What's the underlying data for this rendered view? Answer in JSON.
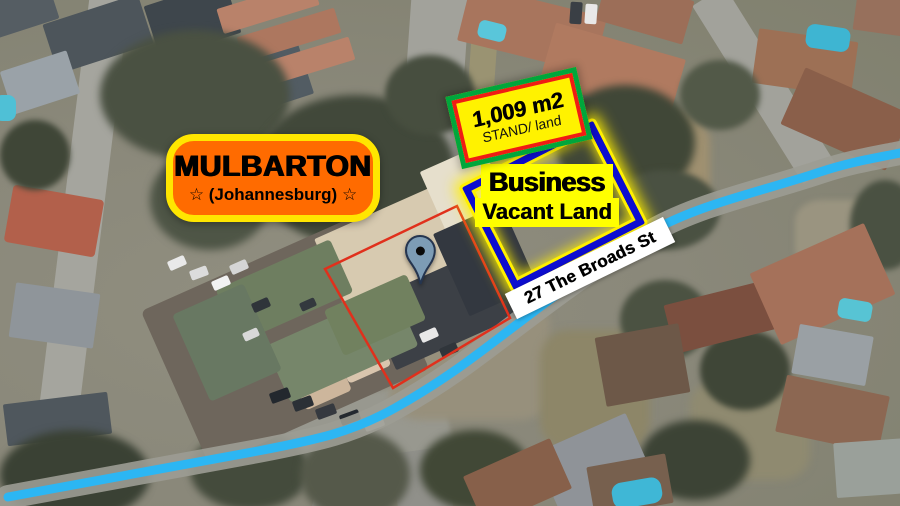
{
  "colors": {
    "brand-orange": "#ff6b00",
    "brand-yellow": "#ffe600",
    "stand-yellow": "#fff200",
    "stand-green": "#00a63c",
    "stand-red": "#f01c14",
    "plot-blue": "#0d0dd0",
    "plot-glow": "#ffef00",
    "label-yellow": "#ffff00",
    "road-highlight": "#2cb6f3",
    "road-gray": "#9c9c94",
    "red-outline": "#e0301c",
    "banner-white": "#ffffff",
    "text-black": "#000000",
    "pin-fill": "#7d9cb5",
    "pin-stroke": "#25354f"
  },
  "area_label": {
    "title": "MULBARTON",
    "subtitle": "☆  (Johannesburg)  ☆"
  },
  "stand_label": {
    "size": "1,009 m2",
    "type": "STAND/ land"
  },
  "plot_label": {
    "line1": "Business",
    "line2": "Vacant Land"
  },
  "street_label": {
    "name": "27 The Broads St"
  },
  "shapes": {
    "highlight_road_path": "M8 497 L258 451 C320 439 352 432 395 408 C450 377 480 352 520 322 C565 288 610 255 652 231 C700 204 760 192 820 172 C850 162 875 158 900 153",
    "red_plot_points": "325,269 457,206 510,318 393,388"
  },
  "map_features": [
    {
      "n": "aerial-road",
      "x": 58,
      "y": -15,
      "w": 40,
      "h": 540,
      "c": "#a5a59e",
      "r": 7
    },
    {
      "n": "aerial-road",
      "x": 405,
      "y": -10,
      "w": 58,
      "h": 200,
      "c": "#a2a29b",
      "r": 4
    },
    {
      "n": "aerial-verge",
      "x": 468,
      "y": 0,
      "w": 26,
      "h": 175,
      "c": "#9a9372",
      "r": 4
    },
    {
      "n": "aerial-road",
      "x": 745,
      "y": -20,
      "w": 38,
      "h": 210,
      "c": "#a2a29b",
      "r": -32
    },
    {
      "n": "aerial-road",
      "x": 230,
      "y": 400,
      "w": 220,
      "h": 80,
      "c": "#98988f",
      "r": -12,
      "br": "10px",
      "bl": 2
    },
    {
      "n": "aerial-road",
      "x": 320,
      "y": 440,
      "w": 60,
      "h": 80,
      "c": "#93938a",
      "r": 15
    },
    {
      "n": "aerial-road",
      "x": 395,
      "y": 450,
      "w": 55,
      "h": 70,
      "c": "#90908a",
      "r": -8
    },
    {
      "n": "aerial-ground",
      "x": 580,
      "y": 110,
      "w": 130,
      "h": 110,
      "c": "#9f9070",
      "br": "30%",
      "bl": 4
    },
    {
      "n": "aerial-ground",
      "x": 390,
      "y": 300,
      "w": 160,
      "h": 120,
      "c": "#97907c",
      "br": "20%",
      "bl": 4
    },
    {
      "n": "aerial-ground",
      "x": 690,
      "y": 380,
      "w": 120,
      "h": 100,
      "c": "#8f8a70",
      "br": "25%",
      "bl": 4
    },
    {
      "n": "aerial-ground",
      "x": 540,
      "y": 330,
      "w": 110,
      "h": 120,
      "c": "#8d8668",
      "br": "25%",
      "bl": 4
    },
    {
      "n": "aerial-ground",
      "x": 795,
      "y": 200,
      "w": 90,
      "h": 70,
      "c": "#9a9480",
      "br": "30%",
      "bl": 3
    },
    {
      "n": "aerial-house",
      "x": -15,
      "y": -10,
      "w": 70,
      "h": 40,
      "c": "#555d63",
      "r": -18
    },
    {
      "n": "aerial-house",
      "x": 48,
      "y": 8,
      "w": 100,
      "h": 52,
      "c": "#4d555b",
      "r": -18
    },
    {
      "n": "aerial-house",
      "x": 150,
      "y": -8,
      "w": 85,
      "h": 55,
      "c": "#3e464c",
      "r": -18
    },
    {
      "n": "aerial-house",
      "x": 228,
      "y": 55,
      "w": 80,
      "h": 52,
      "c": "#525c63",
      "r": -18
    },
    {
      "n": "aerial-house",
      "x": 5,
      "y": 60,
      "w": 70,
      "h": 45,
      "c": "#9aa2a8",
      "r": -18
    },
    {
      "n": "aerial-house",
      "x": 218,
      "y": -6,
      "w": 100,
      "h": 26,
      "c": "#b9826a",
      "r": -17
    },
    {
      "n": "aerial-house",
      "x": 238,
      "y": 22,
      "w": 102,
      "h": 26,
      "c": "#ad775f",
      "r": -17
    },
    {
      "n": "aerial-house",
      "x": 258,
      "y": 50,
      "w": 96,
      "h": 24,
      "c": "#b9826a",
      "r": -17
    },
    {
      "n": "aerial-pool",
      "x": -6,
      "y": 95,
      "w": 22,
      "h": 26,
      "c": "#4fc0d6",
      "br": "8px"
    },
    {
      "n": "aerial-house",
      "x": 8,
      "y": 192,
      "w": 92,
      "h": 58,
      "c": "#b2604b",
      "r": 10,
      "br": "4px"
    },
    {
      "n": "aerial-house",
      "x": 12,
      "y": 288,
      "w": 85,
      "h": 55,
      "c": "#8f959a",
      "r": 8
    },
    {
      "n": "aerial-house",
      "x": 5,
      "y": 398,
      "w": 105,
      "h": 42,
      "c": "#4f575d",
      "r": -7
    },
    {
      "n": "aerial-house",
      "x": 462,
      "y": 0,
      "w": 140,
      "h": 58,
      "c": "#a8755d",
      "r": 14
    },
    {
      "n": "aerial-house",
      "x": 545,
      "y": 40,
      "w": 135,
      "h": 62,
      "c": "#b07a60",
      "r": 16
    },
    {
      "n": "aerial-house",
      "x": 600,
      "y": -12,
      "w": 90,
      "h": 45,
      "c": "#9c6e58",
      "r": 16
    },
    {
      "n": "aerial-house",
      "x": 755,
      "y": 35,
      "w": 100,
      "h": 55,
      "c": "#9d7055",
      "r": 8
    },
    {
      "n": "aerial-house",
      "x": 788,
      "y": 88,
      "w": 115,
      "h": 62,
      "c": "#8a5f4a",
      "r": 24
    },
    {
      "n": "aerial-house",
      "x": 855,
      "y": -5,
      "w": 50,
      "h": 38,
      "c": "#97705c",
      "r": 8
    },
    {
      "n": "aerial-pool",
      "x": 478,
      "y": 22,
      "w": 28,
      "h": 18,
      "c": "#59c6da",
      "r": 14,
      "br": "6px"
    },
    {
      "n": "aerial-pool",
      "x": 806,
      "y": 26,
      "w": 44,
      "h": 24,
      "c": "#3eb5d2",
      "r": 8,
      "br": "8px"
    },
    {
      "n": "aerial-car",
      "x": 570,
      "y": 2,
      "w": 12,
      "h": 22,
      "c": "#3a3f45",
      "r": 4
    },
    {
      "n": "aerial-car",
      "x": 585,
      "y": 4,
      "w": 12,
      "h": 20,
      "c": "#e8e8e8",
      "r": 4
    },
    {
      "n": "aerial-trees",
      "x": 100,
      "y": 30,
      "w": 190,
      "h": 130,
      "c": "#4a5142",
      "br": "50%",
      "bl": 4
    },
    {
      "n": "aerial-trees",
      "x": 255,
      "y": 95,
      "w": 200,
      "h": 150,
      "c": "#41483a",
      "br": "50%",
      "bl": 4
    },
    {
      "n": "aerial-trees",
      "x": 150,
      "y": 150,
      "w": 120,
      "h": 100,
      "c": "#4e5546",
      "br": "50%",
      "bl": 4
    },
    {
      "n": "aerial-trees",
      "x": 385,
      "y": 55,
      "w": 90,
      "h": 80,
      "c": "#474e3f",
      "br": "50%",
      "bl": 3
    },
    {
      "n": "aerial-trees",
      "x": 555,
      "y": 85,
      "w": 140,
      "h": 115,
      "c": "#404737",
      "br": "50%",
      "bl": 4
    },
    {
      "n": "aerial-trees",
      "x": 610,
      "y": 170,
      "w": 110,
      "h": 80,
      "c": "#4a5142",
      "br": "50%",
      "bl": 3
    },
    {
      "n": "aerial-trees",
      "x": 680,
      "y": 60,
      "w": 80,
      "h": 70,
      "c": "#525948",
      "br": "50%",
      "bl": 3
    },
    {
      "n": "aerial-trees",
      "x": 0,
      "y": 120,
      "w": 70,
      "h": 70,
      "c": "#3f4637",
      "br": "50%",
      "bl": 3
    },
    {
      "n": "aerial-trees",
      "x": 0,
      "y": 430,
      "w": 150,
      "h": 90,
      "c": "#3a4134",
      "br": "50%",
      "bl": 4
    },
    {
      "n": "aerial-trees",
      "x": 190,
      "y": 430,
      "w": 120,
      "h": 80,
      "c": "#444b3c",
      "br": "50%",
      "bl": 4
    },
    {
      "n": "aerial-trees",
      "x": 290,
      "y": 240,
      "w": 70,
      "h": 60,
      "c": "#49503f",
      "br": "50%",
      "bl": 3
    },
    {
      "n": "aerial-trees",
      "x": 420,
      "y": 430,
      "w": 110,
      "h": 80,
      "c": "#414836",
      "br": "50%",
      "bl": 4
    },
    {
      "n": "aerial-trees",
      "x": 300,
      "y": 430,
      "w": 110,
      "h": 90,
      "c": "#55594a",
      "br": "50%",
      "bl": 4
    },
    {
      "n": "aerial-trees",
      "x": 620,
      "y": 280,
      "w": 90,
      "h": 80,
      "c": "#4b5242",
      "br": "50%",
      "bl": 3
    },
    {
      "n": "aerial-trees",
      "x": 700,
      "y": 330,
      "w": 90,
      "h": 80,
      "c": "#3f4637",
      "br": "50%",
      "bl": 3
    },
    {
      "n": "aerial-trees",
      "x": 850,
      "y": 180,
      "w": 70,
      "h": 90,
      "c": "#4a5142",
      "br": "50%",
      "bl": 3
    },
    {
      "n": "aerial-trees",
      "x": 640,
      "y": 420,
      "w": 110,
      "h": 80,
      "c": "#3c4335",
      "br": "50%",
      "bl": 4
    },
    {
      "n": "aerial-parking",
      "x": 165,
      "y": 255,
      "w": 240,
      "h": 170,
      "c": "#6e665c",
      "r": -24,
      "br": "6px"
    },
    {
      "n": "aerial-building",
      "x": 325,
      "y": 205,
      "w": 150,
      "h": 85,
      "c": "#d7cab0",
      "r": -24
    },
    {
      "n": "aerial-building",
      "x": 432,
      "y": 155,
      "w": 68,
      "h": 75,
      "c": "#e6dfcc",
      "r": -24
    },
    {
      "n": "aerial-shadow",
      "x": 375,
      "y": 270,
      "w": 140,
      "h": 75,
      "c": "#3c4046",
      "r": -24
    },
    {
      "n": "aerial-shadow",
      "x": 448,
      "y": 215,
      "w": 75,
      "h": 90,
      "c": "#333840",
      "r": -24
    },
    {
      "n": "aerial-gazebo",
      "x": 340,
      "y": 340,
      "w": 46,
      "h": 36,
      "c": "#d9c5ad",
      "r": -24,
      "br": "4px"
    },
    {
      "n": "aerial-gazebo",
      "x": 296,
      "y": 362,
      "w": 50,
      "h": 40,
      "c": "#cdb69c",
      "r": -24,
      "br": "4px"
    },
    {
      "n": "aerial-building",
      "x": 222,
      "y": 262,
      "w": 125,
      "h": 58,
      "c": "#6e7e60",
      "r": -24,
      "br": "4px"
    },
    {
      "n": "aerial-building",
      "x": 272,
      "y": 315,
      "w": 140,
      "h": 62,
      "c": "#76866a",
      "r": -24,
      "br": "4px"
    },
    {
      "n": "aerial-building",
      "x": 188,
      "y": 295,
      "w": 78,
      "h": 95,
      "c": "#687862",
      "r": -24,
      "br": "4px"
    },
    {
      "n": "aerial-building",
      "x": 330,
      "y": 290,
      "w": 90,
      "h": 50,
      "c": "#71815f",
      "r": -24,
      "br": "4px"
    },
    {
      "n": "aerial-car",
      "x": 168,
      "y": 258,
      "w": 18,
      "h": 10,
      "c": "#e9e9e9",
      "r": -24
    },
    {
      "n": "aerial-car",
      "x": 190,
      "y": 268,
      "w": 18,
      "h": 10,
      "c": "#dcdcdc",
      "r": -20
    },
    {
      "n": "aerial-car",
      "x": 212,
      "y": 278,
      "w": 18,
      "h": 10,
      "c": "#f2f2f2",
      "r": -24
    },
    {
      "n": "aerial-car",
      "x": 230,
      "y": 262,
      "w": 18,
      "h": 10,
      "c": "#d5d5d5",
      "r": -24
    },
    {
      "n": "aerial-car",
      "x": 252,
      "y": 300,
      "w": 18,
      "h": 10,
      "c": "#2f343a",
      "r": -24
    },
    {
      "n": "aerial-car",
      "x": 270,
      "y": 390,
      "w": 20,
      "h": 11,
      "c": "#23282e",
      "r": -20
    },
    {
      "n": "aerial-car",
      "x": 293,
      "y": 398,
      "w": 20,
      "h": 11,
      "c": "#2b3036",
      "r": -20
    },
    {
      "n": "aerial-car",
      "x": 316,
      "y": 406,
      "w": 20,
      "h": 11,
      "c": "#35393f",
      "r": -20
    },
    {
      "n": "aerial-car",
      "x": 340,
      "y": 412,
      "w": 20,
      "h": 11,
      "c": "#24292f",
      "r": -20
    },
    {
      "n": "aerial-car",
      "x": 364,
      "y": 418,
      "w": 20,
      "h": 11,
      "c": "#ececec",
      "r": -20
    },
    {
      "n": "aerial-car",
      "x": 420,
      "y": 330,
      "w": 18,
      "h": 10,
      "c": "#e8e8e8",
      "r": -24
    },
    {
      "n": "aerial-car",
      "x": 440,
      "y": 345,
      "w": 18,
      "h": 10,
      "c": "#30353b",
      "r": -24
    },
    {
      "n": "aerial-car",
      "x": 243,
      "y": 330,
      "w": 16,
      "h": 9,
      "c": "#d8d8d8",
      "r": -24
    },
    {
      "n": "aerial-car",
      "x": 300,
      "y": 300,
      "w": 16,
      "h": 9,
      "c": "#33383e",
      "r": -24
    },
    {
      "n": "aerial-house",
      "x": 668,
      "y": 292,
      "w": 105,
      "h": 50,
      "c": "#7b4f3f",
      "r": -14
    },
    {
      "n": "aerial-house",
      "x": 600,
      "y": 330,
      "w": 85,
      "h": 70,
      "c": "#6d5848",
      "r": -10
    },
    {
      "n": "aerial-house",
      "x": 760,
      "y": 245,
      "w": 125,
      "h": 78,
      "c": "#a5715a",
      "r": -24
    },
    {
      "n": "aerial-house",
      "x": 795,
      "y": 330,
      "w": 75,
      "h": 50,
      "c": "#9aa0a4",
      "r": 10
    },
    {
      "n": "aerial-house",
      "x": 780,
      "y": 385,
      "w": 105,
      "h": 58,
      "c": "#8c6752",
      "r": 12
    },
    {
      "n": "aerial-house",
      "x": 835,
      "y": 440,
      "w": 90,
      "h": 55,
      "c": "#9aa09a",
      "r": -4
    },
    {
      "n": "aerial-house",
      "x": 545,
      "y": 430,
      "w": 100,
      "h": 75,
      "c": "#8f9398",
      "r": -24
    },
    {
      "n": "aerial-house",
      "x": 470,
      "y": 455,
      "w": 95,
      "h": 55,
      "c": "#87604a",
      "r": -24
    },
    {
      "n": "aerial-house",
      "x": 590,
      "y": 460,
      "w": 80,
      "h": 50,
      "c": "#77604e",
      "r": -10
    },
    {
      "n": "aerial-pool",
      "x": 612,
      "y": 480,
      "w": 50,
      "h": 26,
      "c": "#3fb7d6",
      "br": "10px",
      "r": -10
    },
    {
      "n": "aerial-pool",
      "x": 838,
      "y": 300,
      "w": 34,
      "h": 20,
      "c": "#57c4d4",
      "br": "6px",
      "r": 10
    }
  ]
}
